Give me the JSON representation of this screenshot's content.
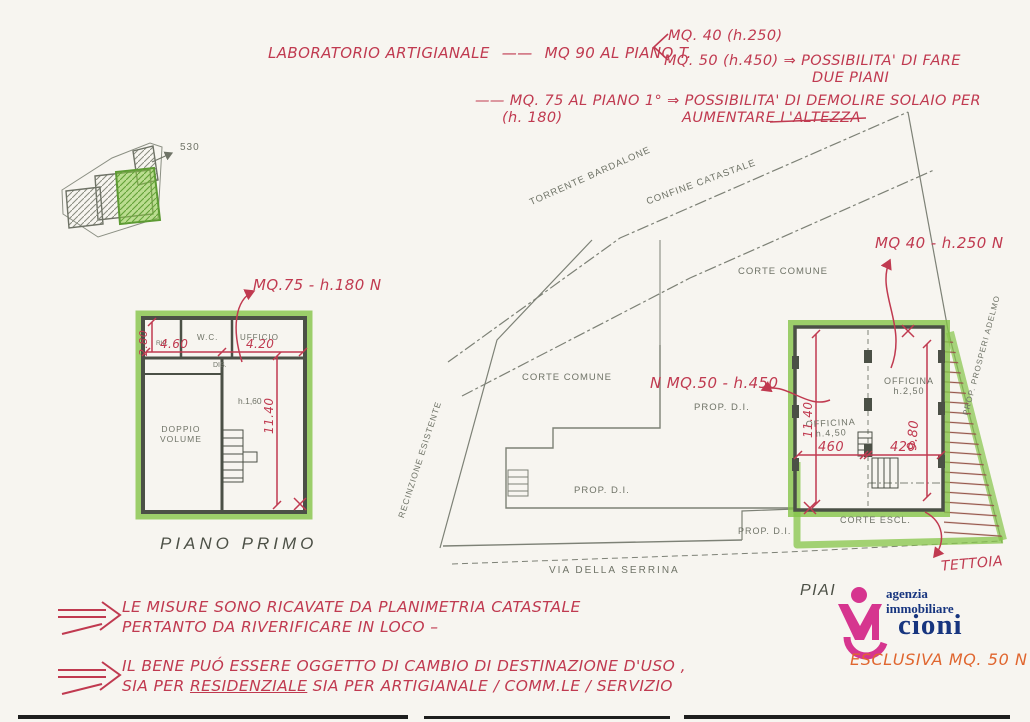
{
  "colors": {
    "ink_red": "#c03a50",
    "pencil_gray": "#6f7367",
    "marker_green": "#85c448",
    "logo_pink": "#d6358f",
    "logo_blue": "#17357f",
    "exclusive_orange": "#e0662f"
  },
  "top_note": {
    "line1_label": "LABORATORIO ARTIGIANALE",
    "line1_dash": "——",
    "line1_value": "MQ  90 AL PIANO T.",
    "branch_a": "MQ. 40 (h.250)",
    "branch_b": "MQ. 50 (h.450) ⇒ POSSIBILITA' DI FARE",
    "branch_b2": "DUE PIANI",
    "line2": "—— MQ. 75 AL PIANO 1° ⇒ POSSIBILITA' DI DEMOLIRE SOLAIO PER",
    "line2_h": "(h. 180)",
    "line2_tail": "AUMENTARE L'ALTEZZA"
  },
  "site_inset": {
    "distance_label": "530"
  },
  "first_floor": {
    "annotation": "MQ.75 - h.180 N",
    "caption": "PIANO PRIMO",
    "rooms": {
      "rip": "RIP.",
      "wc": "W.C.",
      "ufficio": "UFFICIO",
      "dis": "DIS.",
      "doppio_volume": "DOPPIO\nVOLUME"
    },
    "dims": {
      "width_left": "4.60",
      "width_right": "4.20",
      "height_note": "h.1,60",
      "vertical": "11.40",
      "vertical_small": "2.80"
    }
  },
  "ground_floor": {
    "labels": {
      "torrente": "TORRENTE BARDALONE",
      "confine": "CONFINE CATASTALE",
      "corte_comune_1": "CORTE COMUNE",
      "corte_comune_2": "CORTE COMUNE",
      "prop_di_1": "PROP. D.I.",
      "prop_di_2": "PROP. D.I.",
      "prop_di_3": "PROP. D.I.",
      "recinzione": "RECINZIONE ESISTENTE",
      "corte_escl": "CORTE ESCL.",
      "officina_left": "OFFICINA\nh.4,50",
      "officina_right": "OFFICINA\nh.2,50",
      "prop_right": "PROP.  PROSPERI  ADELMO",
      "street": "VIA DELLA SERRINA",
      "piai": "PIAI"
    },
    "red_notes": {
      "mq40": "MQ 40 - h.250 N",
      "mq50": "N MQ.50 - h.450",
      "tettoia": "TETTOIA"
    },
    "dims": {
      "v_left": "11.40",
      "v_right": "9.80",
      "h_left": "460",
      "h_right": "420"
    }
  },
  "notes": {
    "measure_1": "LE MISURE SONO RICAVATE DA PLANIMETRIA CATASTALE",
    "measure_2": "PERTANTO DA RIVERIFICARE IN LOCO –",
    "usage_1": "IL BENE PUÓ ESSERE OGGETTO DI CAMBIO DI DESTINAZIONE D'USO ,",
    "usage_2_pre": "SIA PER ",
    "usage_2_underline": "RESIDENZIALE",
    "usage_2_post": " SIA PER ARTIGIANALE / COMM.LE / SERVIZIO"
  },
  "logo": {
    "line1": "agenzia",
    "line2": "immobiliare",
    "name": "cioni",
    "exclusive": "ESCLUSIVA MQ. 50 N"
  }
}
